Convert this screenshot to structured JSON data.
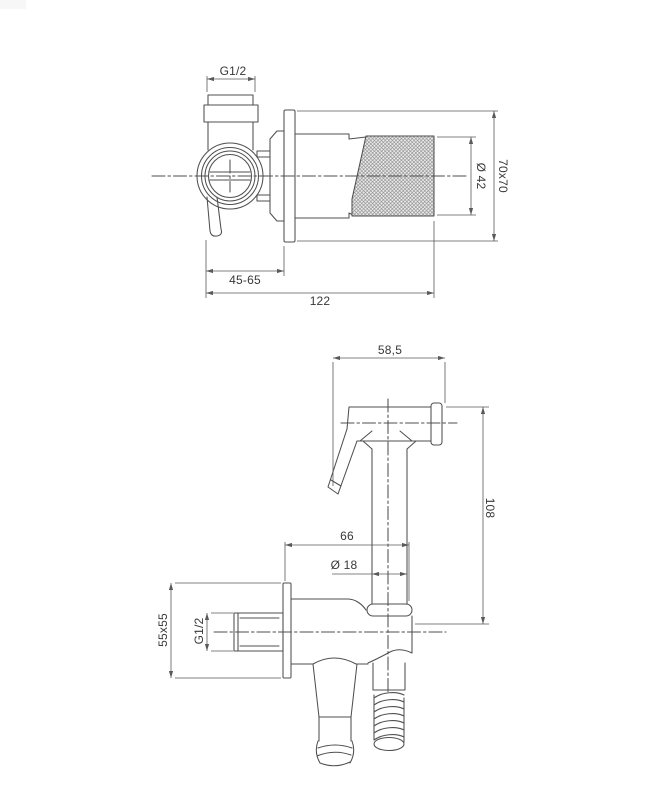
{
  "drawing": {
    "background": "#ffffff",
    "line_color": "#4f4f4f",
    "dim_line_color": "#5a5a5a",
    "text_color": "#383838",
    "knurl_line_color": "#8a8a8a",
    "knurl_bg_color": "#ededed",
    "watermark_color": "#f7f7f7",
    "top_view": {
      "name": "concealed angle valve - side view",
      "dimensions": {
        "inlet_thread": "G1/2",
        "handle_diameter": "Ø 42",
        "wall_plate": "70x70",
        "installation_depth": "45-65",
        "total_length": "122"
      }
    },
    "bottom_view": {
      "name": "hand shower with wall holder and hose - side view",
      "dimensions": {
        "head_length": "58,5",
        "height": "108",
        "reach": "66",
        "handle_diameter": "Ø 18",
        "wall_plate": "55x55",
        "outlet_thread": "G1/2"
      }
    }
  }
}
